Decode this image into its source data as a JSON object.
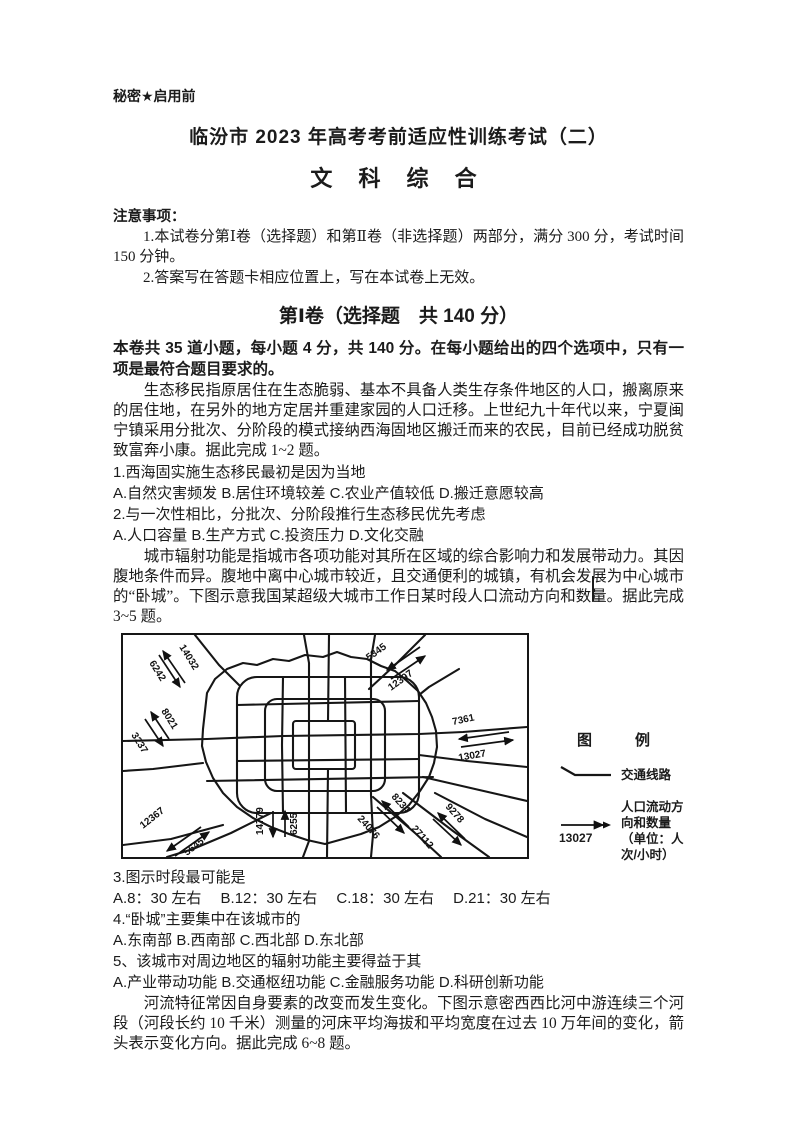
{
  "colors": {
    "ink": "#1b1b1b",
    "paper": "#ffffff"
  },
  "header": {
    "secrecy": "秘密★启用前",
    "exam_title": "临汾市 2023 年高考考前适应性训练考试（二）",
    "subject": "文 科 综 合"
  },
  "notices": {
    "head": "注意事项：",
    "item1": "1.本试卷分第Ⅰ卷（选择题）和第Ⅱ卷（非选择题）两部分，满分 300 分，考试时间 150 分钟。",
    "item2": "2.答案写在答题卡相应位置上，写在本试卷上无效。"
  },
  "section1": {
    "title": "第Ⅰ卷（选择题　共 140 分）",
    "instructions": "本卷共 35 道小题，每小题 4 分，共 140 分。在每小题给出的四个选项中，只有一项是最符合题目要求的。"
  },
  "passages": {
    "p1": "生态移民指原居住在生态脆弱、基本不具备人类生存条件地区的人口，搬离原来的居住地，在另外的地方定居并重建家园的人口迁移。上世纪九十年代以来，宁夏闽宁镇采用分批次、分阶段的模式接纳西海固地区搬迁而来的农民，目前已经成功脱贫致富奔小康。据此完成 1~2 题。",
    "p2": "城市辐射功能是指城市各项功能对其所在区域的综合影响力和发展带动力。其因腹地条件而异。腹地中离中心城市较近，且交通便利的城镇，有机会发展为中心城市的“卧城”。下图示意我国某超级大城市工作日某时段人口流动方向和数量。据此完成 3~5 题。",
    "p3": "河流特征常因自身要素的改变而发生变化。下图示意密西西比河中游连续三个河段（河段长约 10 千米）测量的河床平均海拔和平均宽度在过去 10 万年间的变化，箭头表示变化方向。据此完成 6~8 题。"
  },
  "questions": [
    {
      "stem": "1.西海固实施生态移民最初是因为当地",
      "options": "A.自然灾害频发 B.居住环境较差 C.农业产值较低 D.搬迁意愿较高"
    },
    {
      "stem": "2.与一次性相比，分批次、分阶段推行生态移民优先考虑",
      "options": "A.人口容量 B.生产方式 C.投资压力 D.文化交融"
    },
    {
      "stem": "3.图示时段最可能是",
      "options": "A.8：30 左右　 B.12：30 左右　 C.18：30 左右　 D.21：30 左右"
    },
    {
      "stem": "4.“卧城”主要集中在该城市的",
      "options": "A.东南部 B.西南部 C.西北部 D.东北部"
    },
    {
      "stem": "5、该城市对周边地区的辐射功能主要得益于其",
      "options": "A.产业带动功能 B.交通枢纽功能 C.金融服务功能 D.科研创新功能"
    }
  ],
  "figure": {
    "description": "城市交通线路与人口流动方向示意图",
    "legend": {
      "title": "图　例",
      "line_label": "交通线路",
      "arrow_value": "13027",
      "arrow_label_line1": "人口流动方向和数量",
      "arrow_label_line2": "（单位：人次/小时）"
    },
    "flows": [
      {
        "value": "14032",
        "corner": "northwest",
        "direction": "outbound"
      },
      {
        "value": "6242",
        "corner": "northwest",
        "direction": "inbound"
      },
      {
        "value": "5345",
        "corner": "northeast",
        "direction": "inbound"
      },
      {
        "value": "12397",
        "corner": "northeast",
        "direction": "outbound"
      },
      {
        "value": "8021",
        "corner": "west",
        "direction": "outbound"
      },
      {
        "value": "3237",
        "corner": "west",
        "direction": "inbound"
      },
      {
        "value": "7361",
        "corner": "east",
        "direction": "inbound"
      },
      {
        "value": "13027",
        "corner": "east",
        "direction": "outbound"
      },
      {
        "value": "14779",
        "corner": "south",
        "direction": "outbound"
      },
      {
        "value": "6255",
        "corner": "south",
        "direction": "inbound"
      },
      {
        "value": "12367",
        "corner": "southwest",
        "direction": "outbound"
      },
      {
        "value": "5645",
        "corner": "southwest",
        "direction": "inbound"
      },
      {
        "value": "8234",
        "corner": "southeast",
        "direction": "inbound"
      },
      {
        "value": "24076",
        "corner": "southeast",
        "direction": "outbound"
      },
      {
        "value": "9278",
        "corner": "southeast-outer",
        "direction": "inbound"
      },
      {
        "value": "27112",
        "corner": "southeast-outer",
        "direction": "outbound"
      }
    ]
  }
}
